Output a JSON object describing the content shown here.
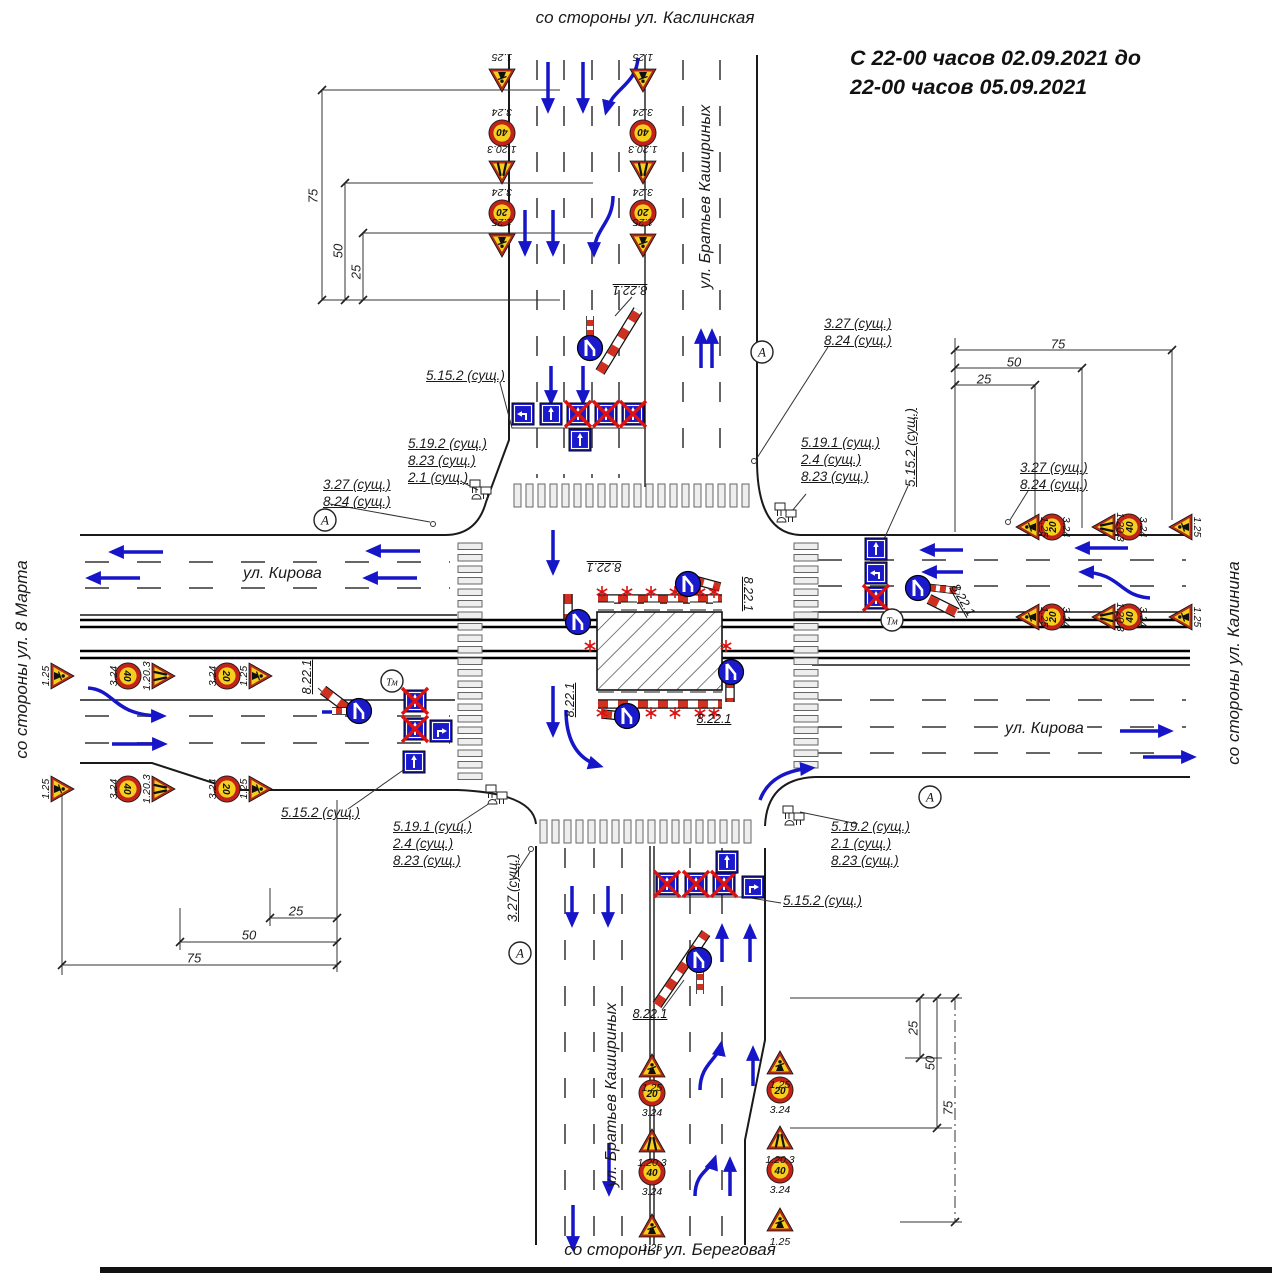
{
  "title": {
    "line1": "С 22-00 часов 02.09.2021 до",
    "line2": "22-00 часов 05.09.2021"
  },
  "directions": {
    "top": "со стороны ул. Каслинская",
    "bottom": "со стороны ул. Береговая",
    "left": "со стороны ул. 8 Марта",
    "right": "со стороны ул. Калинина"
  },
  "streets": {
    "kirova_left": "ул. Кирова",
    "kirova_right": "ул. Кирова",
    "kashirinykh_top": "ул. Братьев Кашириных",
    "kashirinykh_bottom": "ул. Братьев Кашириных"
  },
  "sign_labels": {
    "s1_25": "1.25",
    "s3_24": "3.24",
    "s1_20_3": "1.20.3",
    "speed_40": "40",
    "speed_20": "20",
    "s8_22_1": "8.22.1"
  },
  "annotations": {
    "a5152": "5.15.2 (сущ.)",
    "a5192": "5.19.2 (сущ.)",
    "a5191": "5.19.1 (сущ.)",
    "a823": "8.23 (сущ.)",
    "a824": "8.24 (сущ.)",
    "a21": "2.1 (сущ.)",
    "a24": "2.4 (сущ.)",
    "a327": "3.27 (сущ.)",
    "symbol_a": "А",
    "symbol_tm": "Тм"
  },
  "dimensions": {
    "d25": "25",
    "d50": "50",
    "d75": "75"
  },
  "colors": {
    "arrow_blue": "#1616c8",
    "sign_yellow": "#f5cf1b",
    "sign_red": "#b02a1a",
    "lane_blue": "#1a1acc",
    "cross_red": "#dd1111",
    "barrier_red": "#d03020"
  }
}
